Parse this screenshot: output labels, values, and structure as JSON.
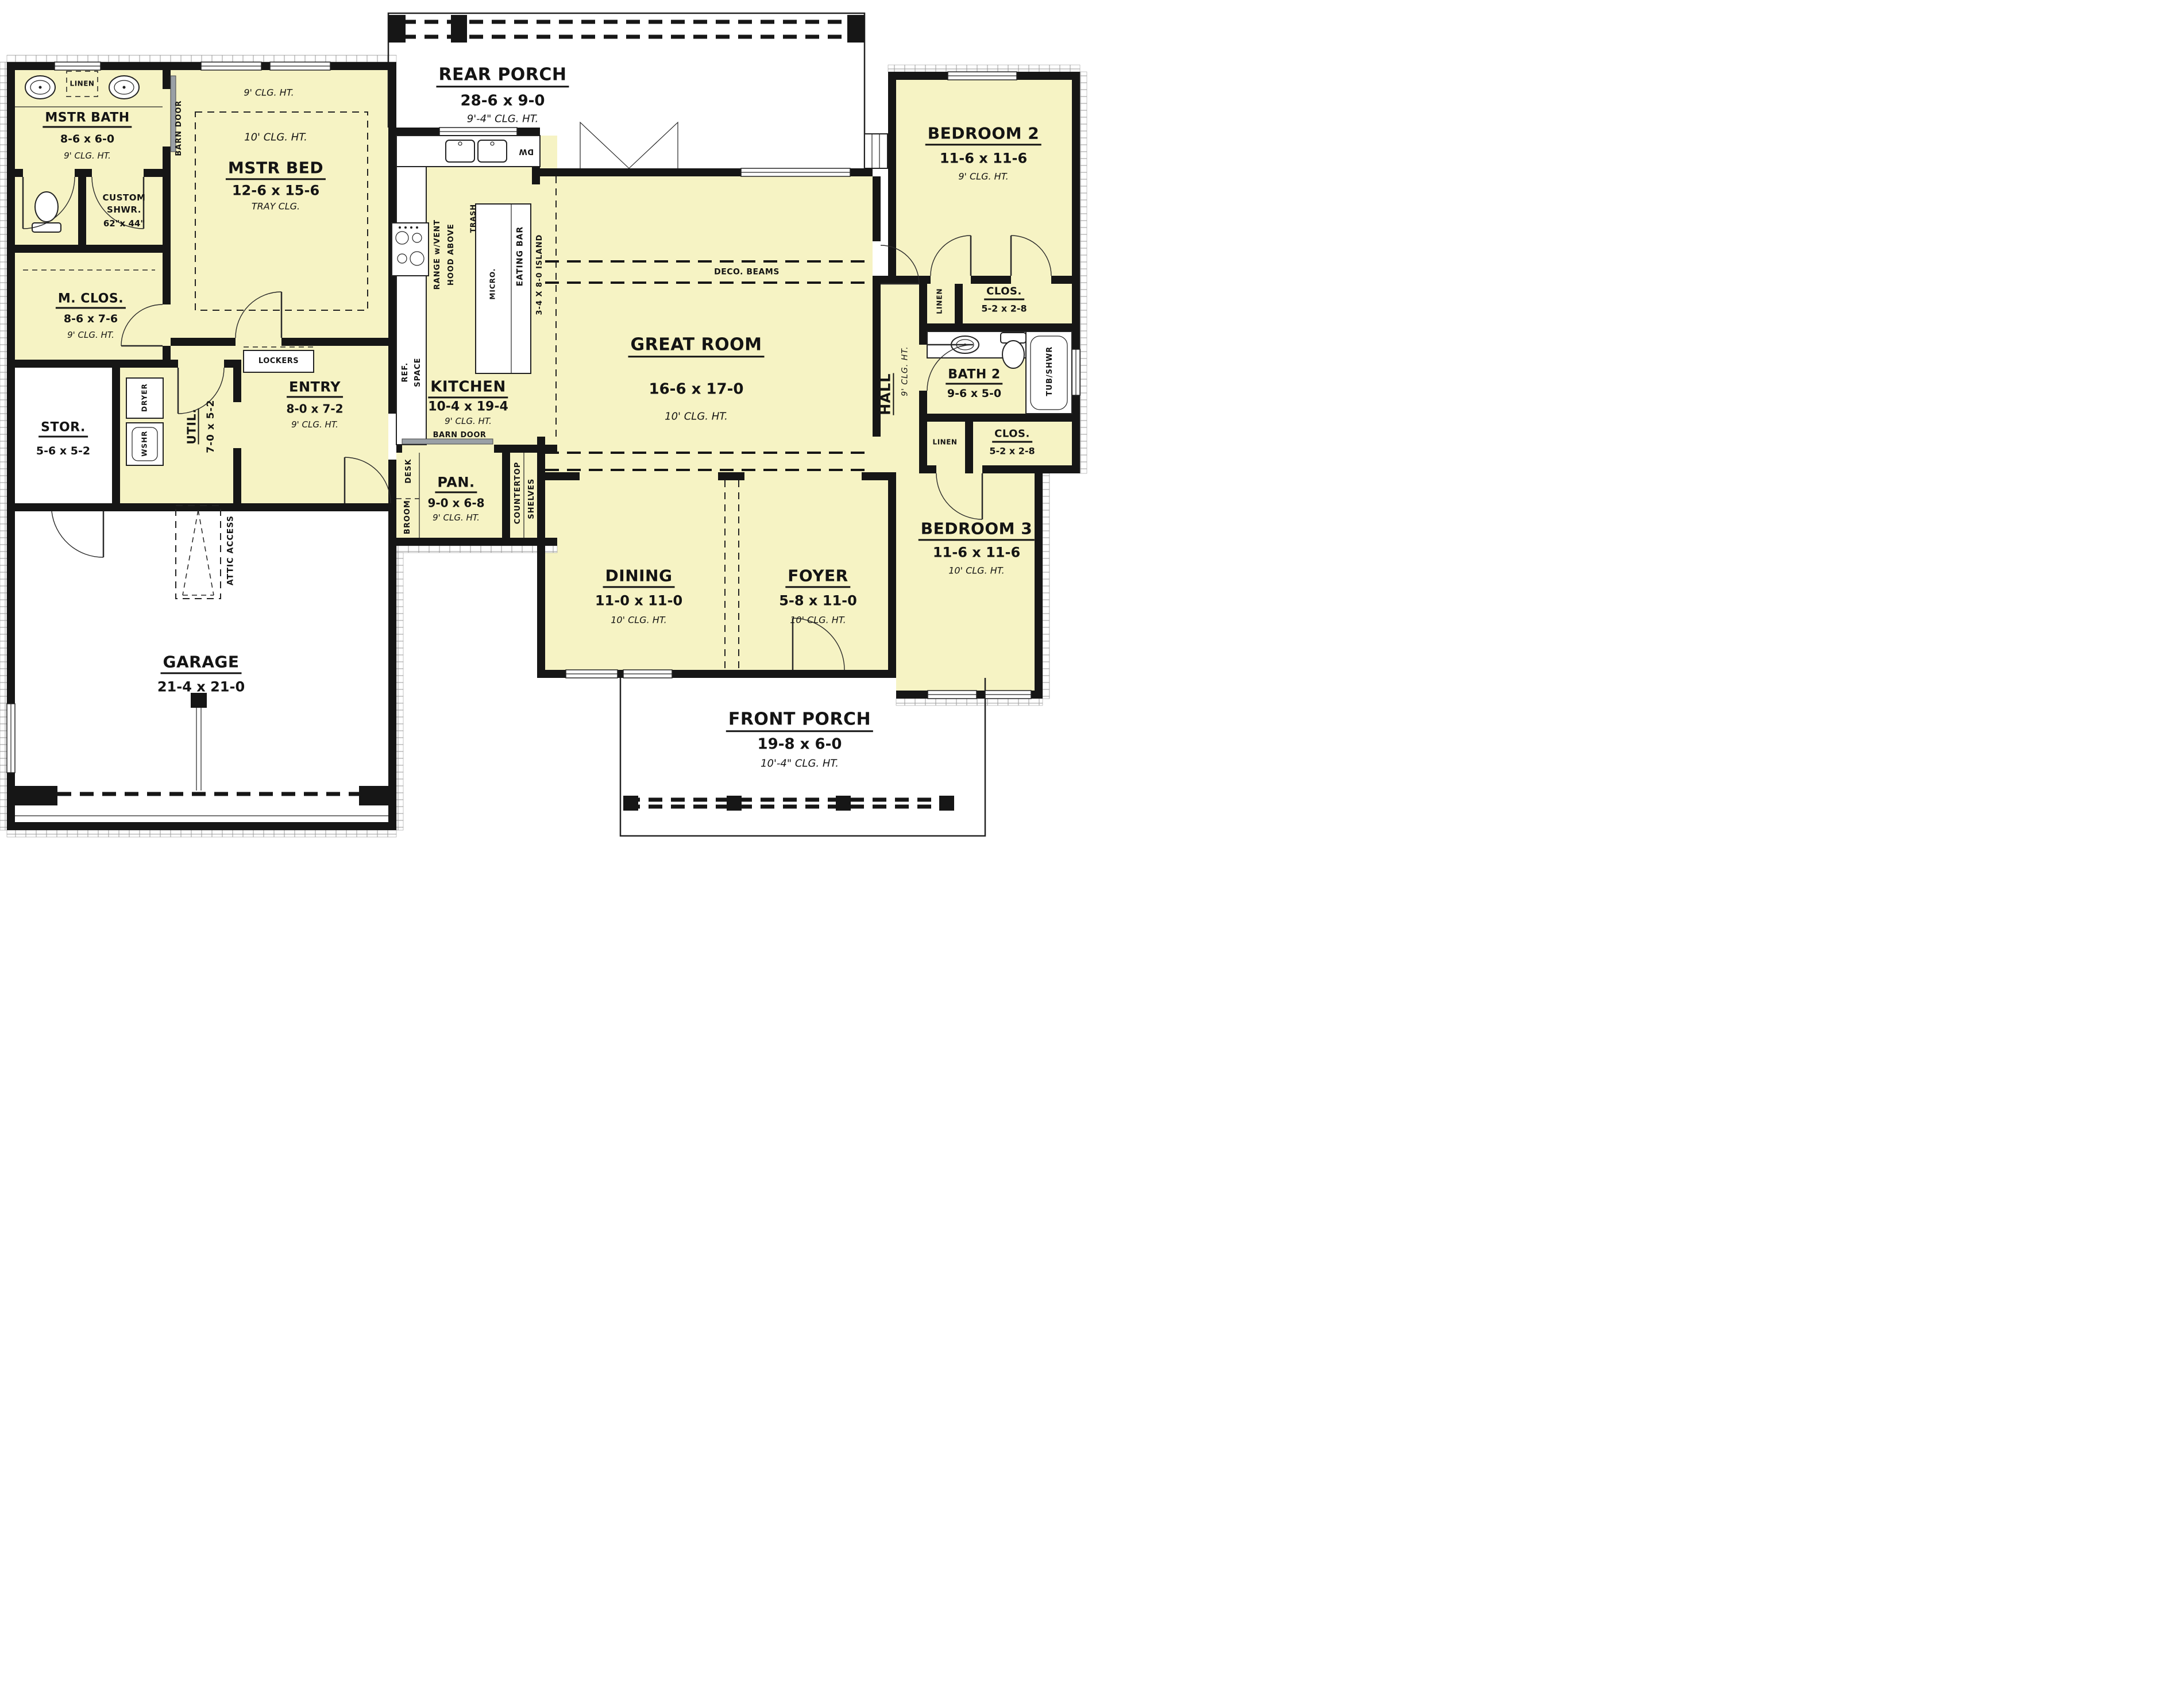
{
  "rooms": {
    "rear_porch": {
      "name": "REAR PORCH",
      "dims": "28-6 x 9-0",
      "ceiling": "9'-4\" CLG. HT."
    },
    "mstr_bath": {
      "name": "MSTR BATH",
      "dims": "8-6 x 6-0",
      "ceiling": "9' CLG. HT."
    },
    "custom_shwr": {
      "line1": "CUSTOM",
      "line2": "SHWR.",
      "dims": "62\"x 44\""
    },
    "m_clos": {
      "name": "M. CLOS.",
      "dims": "8-6 x 7-6",
      "ceiling": "9' CLG. HT."
    },
    "mstr_bed": {
      "name": "MSTR BED",
      "dims": "12-6 x 15-6",
      "ceiling_note": "TRAY CLG.",
      "outer_clg": "9' CLG. HT.",
      "inner_clg": "10' CLG. HT."
    },
    "bedroom2": {
      "name": "BEDROOM 2",
      "dims": "11-6 x 11-6",
      "ceiling": "9' CLG. HT."
    },
    "kitchen": {
      "name": "KITCHEN",
      "dims": "10-4 x 19-4",
      "ceiling": "9' CLG. HT."
    },
    "great_room": {
      "name": "GREAT ROOM",
      "dims": "16-6 x 17-0",
      "ceiling": "10' CLG. HT."
    },
    "hall": {
      "name": "HALL",
      "ceiling": "9' CLG. HT."
    },
    "clos_top": {
      "name": "CLOS.",
      "dims": "5-2 x 2-8"
    },
    "bath2": {
      "name": "BATH 2",
      "dims": "9-6 x 5-0"
    },
    "clos_bottom": {
      "name": "CLOS.",
      "dims": "5-2 x 2-8"
    },
    "bedroom3": {
      "name": "BEDROOM 3",
      "dims": "11-6 x 11-6",
      "ceiling": "10' CLG. HT."
    },
    "dining": {
      "name": "DINING",
      "dims": "11-0 x 11-0",
      "ceiling": "10' CLG. HT."
    },
    "foyer": {
      "name": "FOYER",
      "dims": "5-8 x 11-0",
      "ceiling": "10' CLG. HT."
    },
    "front_porch": {
      "name": "FRONT PORCH",
      "dims": "19-8 x 6-0",
      "ceiling": "10'-4\" CLG. HT."
    },
    "stor": {
      "name": "STOR.",
      "dims": "5-6 x 5-2"
    },
    "util": {
      "name": "UTIL.",
      "dims": "7-0 x 5-2"
    },
    "entry": {
      "name": "ENTRY",
      "dims": "8-0 x 7-2",
      "ceiling": "9' CLG. HT."
    },
    "pan": {
      "name": "PAN.",
      "dims": "9-0 x 6-8",
      "ceiling": "9' CLG. HT."
    },
    "garage": {
      "name": "GARAGE",
      "dims": "21-4 x 21-0"
    }
  },
  "annotations": {
    "linen_mstr_bath": "LINEN",
    "barn_door_mstr": "BARN DOOR",
    "barn_door_kitchen": "BARN DOOR",
    "range_line1": "RANGE w/VENT",
    "range_line2": "HOOD ABOVE",
    "ref_line1": "REF.",
    "ref_line2": "SPACE",
    "dw": "DW",
    "trash": "TRASH",
    "micro": "MICRO.",
    "eating_bar": "EATING BAR",
    "island": "3-4 X 8-0 ISLAND",
    "deco_beams": "DECO. BEAMS",
    "linen_hall_top": "LINEN",
    "tub_shwr": "TUB/SHWR",
    "linen_hall_bottom": "LINEN",
    "wshr": "WSHR",
    "dryer": "DRYER",
    "lockers": "LOCKERS",
    "desk": "DESK",
    "broom": "BROOM",
    "countertop": "COUNTERTOP",
    "shelves": "SHELVES",
    "attic_access": "ATTIC ACCESS"
  },
  "colors": {
    "room_fill": "#f6f3c4",
    "wall": "#161616",
    "door_slider": "#9aa0a6"
  }
}
